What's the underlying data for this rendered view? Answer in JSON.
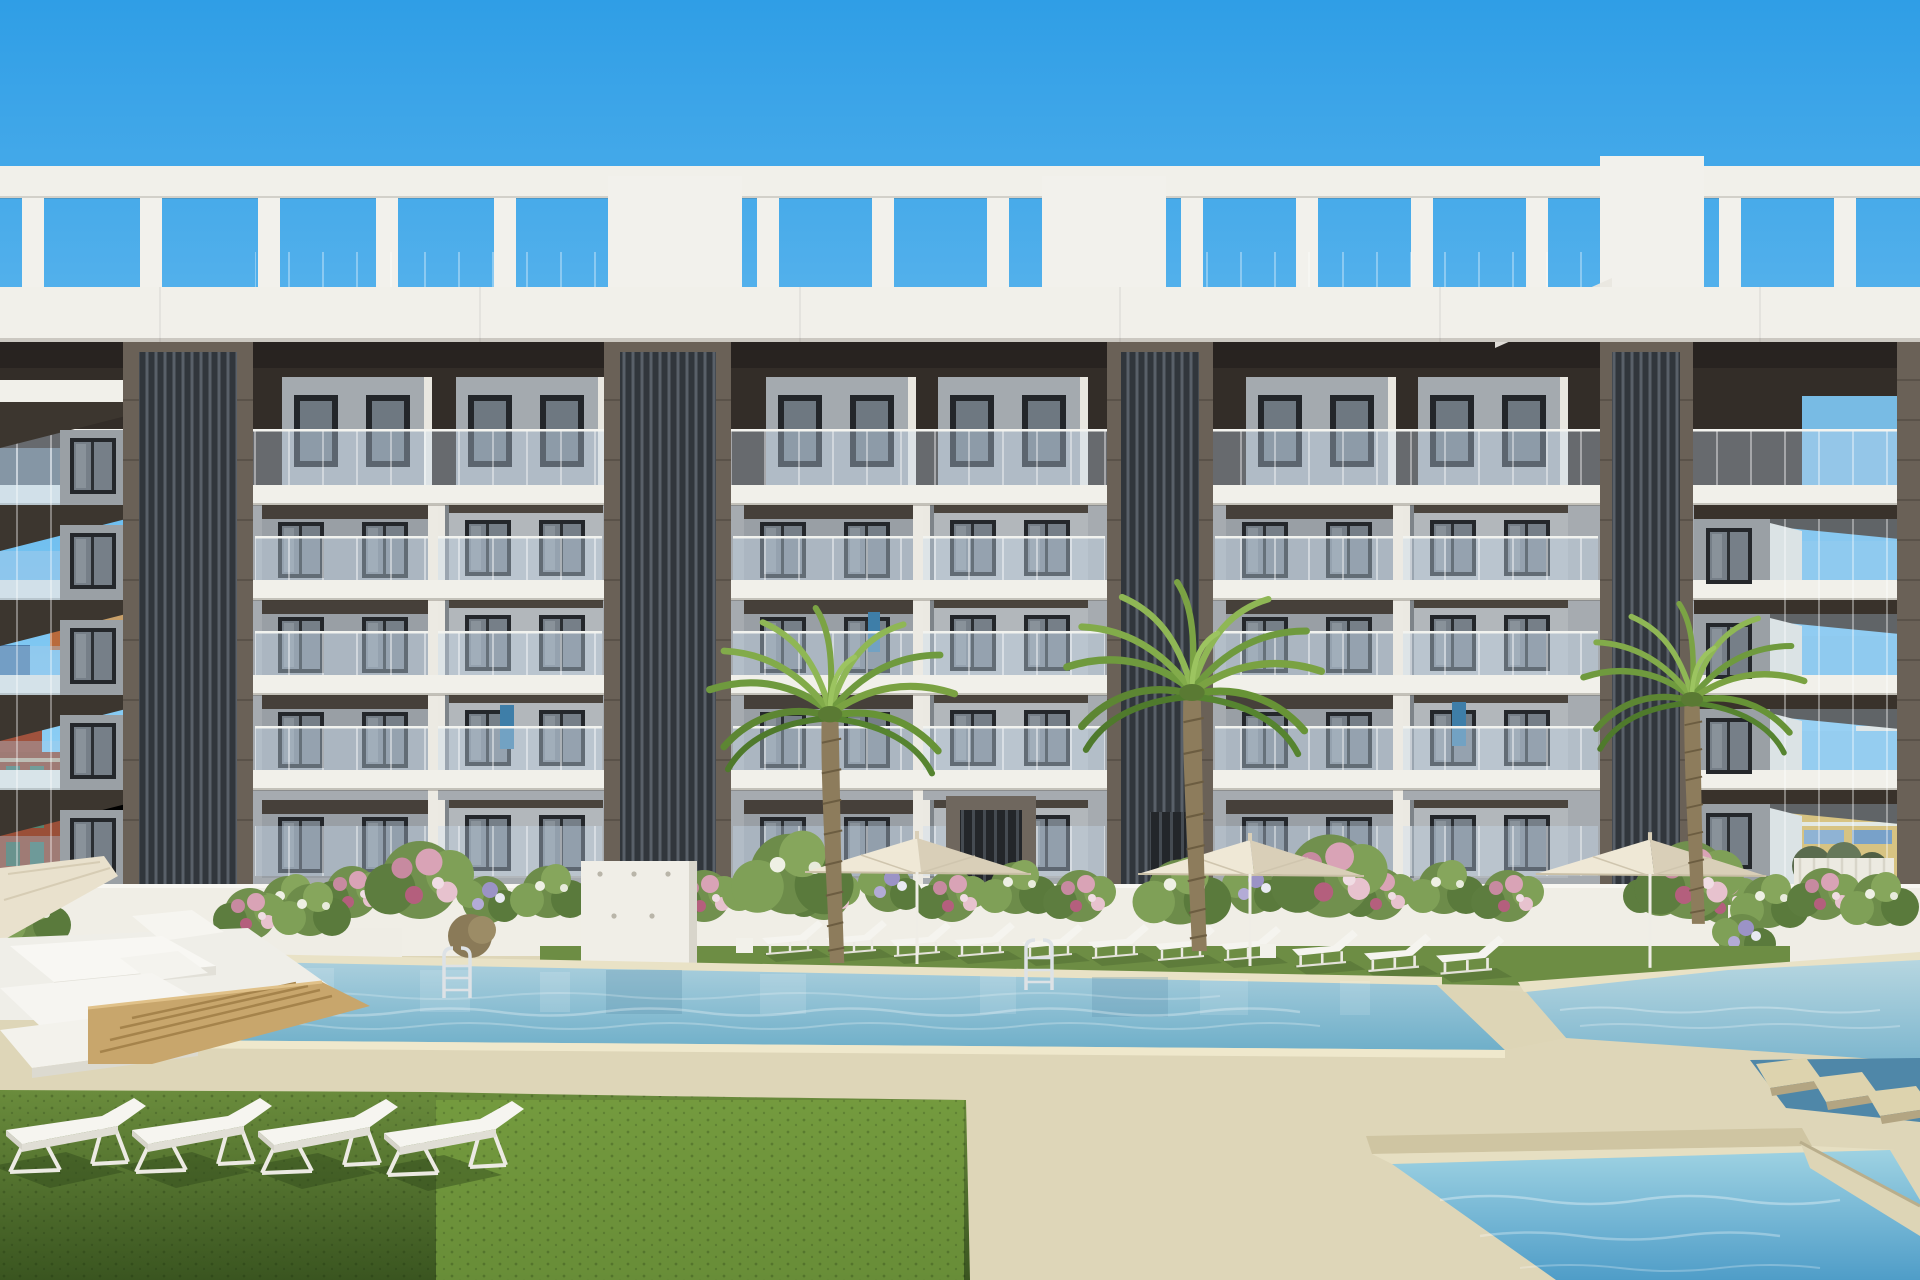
{
  "meta": {
    "description": "3D architectural rendering: modern white apartment block with rooftop pergola, four dark louvre towers, glass balconies, flowering hedge wall, palm trees, cream parasols, white sun loungers and a multi-level turquoise pool area with sand-coloured deck and lawn",
    "width_px": 1920,
    "height_px": 1280
  },
  "palette": {
    "sky_top": "#2f9ee6",
    "sky_bottom": "#90d0f5",
    "building_white": "#f1f0ea",
    "penthouse_dark": "#332d28",
    "facade_gray": "#a6abb0",
    "bay_gray": "#999fa5",
    "bay_gray_light": "#b2b7bb",
    "window_frame": "#24272b",
    "window_glass": "#767f88",
    "tower_frame": "#6a6157",
    "tower_slat": "#31363c",
    "glass_railing": "rgba(200,222,240,0.38)",
    "wall_white": "#f0eee6",
    "hedge_green": "#6d8c4a",
    "flower_pink": "#d9a3b6",
    "palm_frond": "#7aa242",
    "palm_trunk": "#8d7c5c",
    "umbrella_cream": "#efe8d6",
    "lounger_white": "#f5f4ef",
    "water_light": "#aacfdd",
    "water_deep": "#6fafc9",
    "water_lower_light": "#9ed2e2",
    "water_lower_deep": "#4f9dc8",
    "deck_sand": "#ded6b8",
    "grass_strip": "#6d8d44",
    "grass_fg_top": "#6a8c3c",
    "grass_fg_bottom": "#3a5520",
    "wood_step": "#c8a66c",
    "brick_bg": "#9a4f38",
    "yellow_bg": "#e2b952"
  },
  "scene": {
    "sky": "clear blue, brighter toward horizon",
    "building": {
      "floors_visible": 6,
      "louvre_towers": 4,
      "rooftop": "white pergola frames and stair boxes",
      "facade": "white floor slabs, grey panels, dark sliding windows, glass balustrades"
    },
    "background": {
      "left": "red brick building and orange-roofed house",
      "right": "yellow Mediterranean houses and white fence with shrubs"
    },
    "vegetation": {
      "palm_trees": 3,
      "flower_hedge": "white wall covered with green climbers and pink/white/lavender blooms",
      "lawn": "two-tone green"
    },
    "amenities": {
      "pools": 3,
      "parasols": 4,
      "sun_loungers_poolside": 11,
      "sun_loungers_foreground": 4,
      "double_sunbeds": 3,
      "pool_ladders": 2,
      "outdoor_shower_panel": 1,
      "stepping_stones": 3,
      "wooden_deck_steps": 1
    }
  }
}
